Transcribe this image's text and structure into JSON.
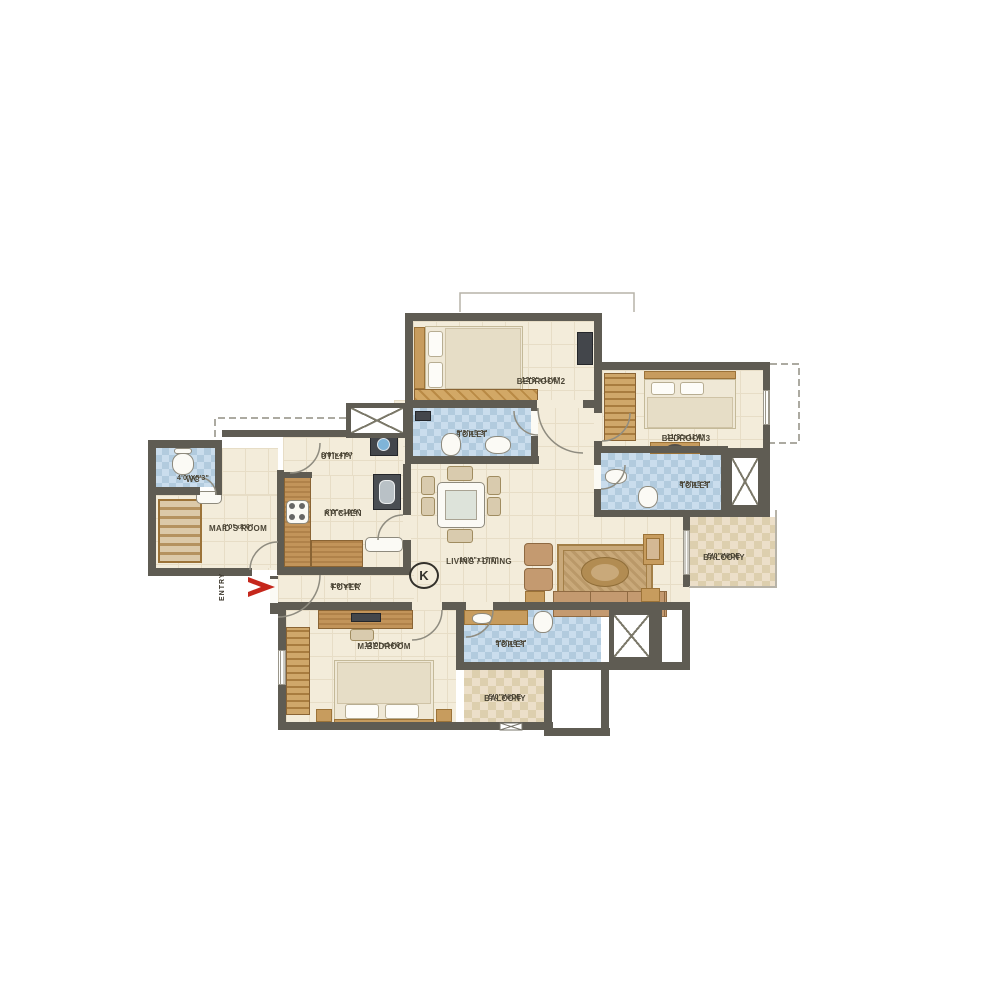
{
  "plan": {
    "compass": {
      "label": "K"
    },
    "entry": {
      "label": "ENTRY"
    },
    "rooms": {
      "bedroom2": {
        "name": "BEDROOM2",
        "dims": "12'3\"x11'6\""
      },
      "bedroom3": {
        "name": "BEDROOM3",
        "dims": "11'3\"x11'0\""
      },
      "toilet_top": {
        "name": "TOILET",
        "dims": "8'3\"x5'3\""
      },
      "toilet_right": {
        "name": "TOILET",
        "dims": "8'3\"x5'3\""
      },
      "toilet_bottom": {
        "name": "TOILET",
        "dims": "9'3\"x6'3\""
      },
      "utility": {
        "name": "UTILITY",
        "dims": "8'0\"x4'6\""
      },
      "kitchen": {
        "name": "KITCHEN",
        "dims": "8'0\"x10'6\""
      },
      "wc": {
        "name": "WC",
        "dims": "4'0\"X5'3\""
      },
      "maids_room": {
        "name": "MAID'S ROOM",
        "dims": "8'0\"x8'0\""
      },
      "living_dining": {
        "name": "LIVING / DINING",
        "dims": "19'0\"x17'7\""
      },
      "foyer": {
        "name": "FOYER",
        "dims": "8'6\"x5'0\""
      },
      "m_bedroom": {
        "name": "M.BEDROOM",
        "dims": "12'0\"x14'0\""
      },
      "balcony_right": {
        "name": "BALCONY",
        "dims": "5'0\"WIDE"
      },
      "balcony_bottom": {
        "name": "BALCONY",
        "dims": "5'0\"WIDE"
      }
    },
    "colors": {
      "wall": "#5f5c53",
      "floor": "#f3ecda",
      "wet_tile": "#cadded",
      "balcony_tile": "#ecdfc9",
      "wood": "#c79c5e",
      "entry_arrow": "#c5271c"
    }
  }
}
